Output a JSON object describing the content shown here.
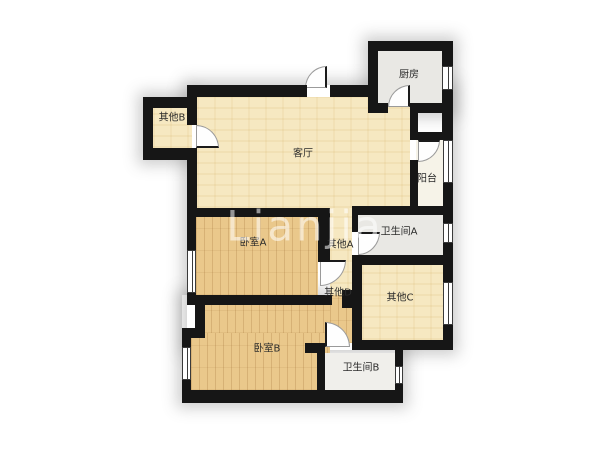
{
  "page": {
    "background": "#ffffff",
    "type": "apartment-floor-plan"
  },
  "watermark": {
    "text": "Lianjia"
  },
  "rooms": [
    {
      "id": "kitchen",
      "label": "厨房",
      "floor": "tile-gray"
    },
    {
      "id": "living-room",
      "label": "客厅",
      "floor": "parquet-cream"
    },
    {
      "id": "other-b",
      "label": "其他B",
      "floor": "parquet-cream"
    },
    {
      "id": "balcony",
      "label": "阳台",
      "floor": "plain-offwhite"
    },
    {
      "id": "bathroom-a",
      "label": "卫生间A",
      "floor": "tile-gray"
    },
    {
      "id": "hall-other-a",
      "label": "其他A",
      "floor": "parquet-cream"
    },
    {
      "id": "bedroom-a",
      "label": "卧室A",
      "floor": "wood-plank"
    },
    {
      "id": "hall-other-d",
      "label": "其他D",
      "floor": "parquet-cream"
    },
    {
      "id": "other-c",
      "label": "其他C",
      "floor": "parquet-cream"
    },
    {
      "id": "bedroom-b",
      "label": "卧室B",
      "floor": "wood-plank"
    },
    {
      "id": "bathroom-b",
      "label": "卫生间B",
      "floor": "plain-offwhite"
    }
  ],
  "colors": {
    "wall": "#161616",
    "floor_cream": "#f6e8c1",
    "floor_wood": "#eac88b",
    "floor_gray": "#e9e8e4",
    "floor_offwhite": "#f6f3e8",
    "label_text": "#2b2b2b"
  }
}
